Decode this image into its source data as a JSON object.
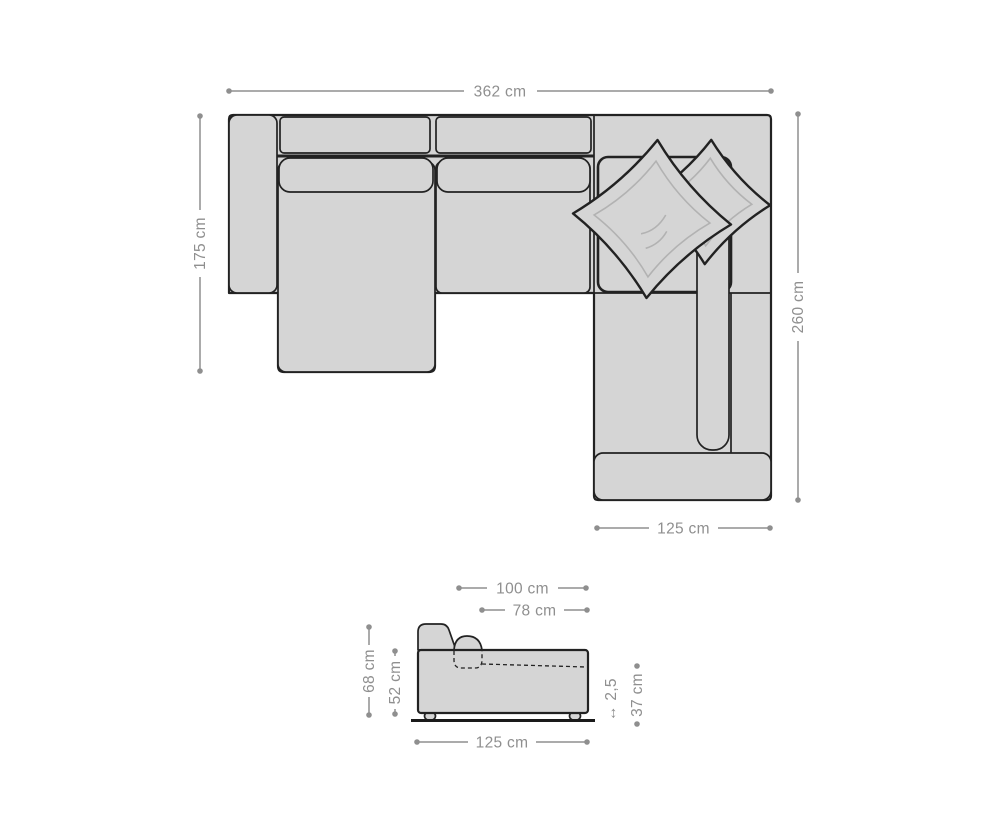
{
  "colors": {
    "background": "#ffffff",
    "dimension": "#8f8f8f",
    "outline": "#222222",
    "sofa_fill": "#d5d5d5",
    "seam": "#b2b2b2",
    "floor": "#1a1a1a"
  },
  "top_view": {
    "total_width": "362 cm",
    "left_depth": "175 cm",
    "right_depth": "260 cm",
    "wing_width": "125 cm"
  },
  "side_view": {
    "upper_width": "100 cm",
    "seat_depth": "78 cm",
    "back_height": "68 cm",
    "body_height": "52 cm",
    "total_depth": "125 cm",
    "base_thickness": "↔ 2,5",
    "ground_clearance": "37 cm"
  }
}
